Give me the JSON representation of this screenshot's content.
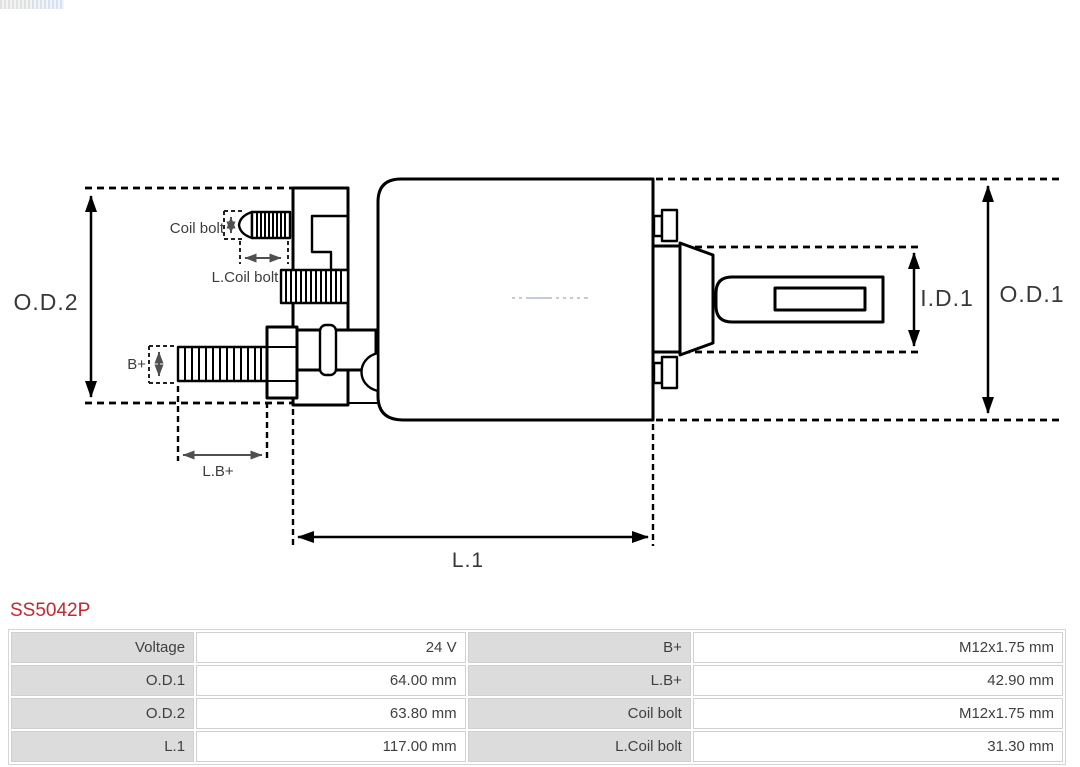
{
  "part": {
    "number": "SS5042P"
  },
  "colors": {
    "part_number": "#c4282e",
    "drawing_line": "#000000",
    "dimension_arrow_small": "#4f4f4f",
    "label_text": "#383838",
    "table_label_bg": "#dcdcdc",
    "table_border": "#d0d0d0",
    "table_text": "#3f3f3f",
    "watermark_centerline": "#c3cbd8"
  },
  "drawing": {
    "labels": {
      "od2": "O.D.2",
      "od1": "O.D.1",
      "id1": "I.D.1",
      "l1": "L.1",
      "coil_bolt": "Coil bolt",
      "l_coil_bolt": "L.Coil bolt",
      "b_plus": "B+",
      "l_b_plus": "L.B+"
    }
  },
  "spec_table": {
    "rows": [
      {
        "left_label": "Voltage",
        "left_value": "24 V",
        "right_label": "B+",
        "right_value": "M12x1.75 mm"
      },
      {
        "left_label": "O.D.1",
        "left_value": "64.00 mm",
        "right_label": "L.B+",
        "right_value": "42.90 mm"
      },
      {
        "left_label": "O.D.2",
        "left_value": "63.80 mm",
        "right_label": "Coil bolt",
        "right_value": "M12x1.75 mm"
      },
      {
        "left_label": "L.1",
        "left_value": "117.00 mm",
        "right_label": "L.Coil bolt",
        "right_value": "31.30 mm"
      }
    ]
  }
}
